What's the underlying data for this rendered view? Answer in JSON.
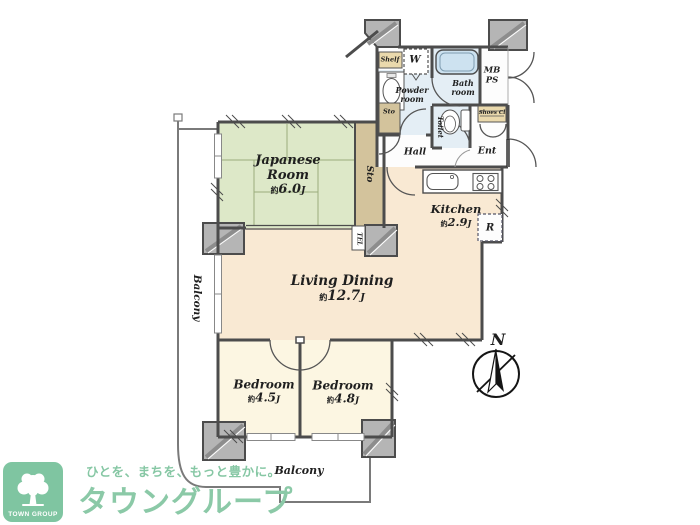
{
  "plan": {
    "rooms": [
      {
        "name": "Japanese Room",
        "area_prefix": "約",
        "area_value": "6.0",
        "area_unit": "J"
      },
      {
        "name": "Living Dining",
        "area_prefix": "約",
        "area_value": "12.7",
        "area_unit": "J"
      },
      {
        "name": "Kitchen",
        "area_prefix": "約",
        "area_value": "2.9",
        "area_unit": "J"
      },
      {
        "name": "Bedroom",
        "area_prefix": "約",
        "area_value": "4.5",
        "area_unit": "J"
      },
      {
        "name": "Bedroom",
        "area_prefix": "約",
        "area_value": "4.8",
        "area_unit": "J"
      }
    ],
    "labels": {
      "shelf": "Shelf",
      "washer": "W",
      "bath_1": "Bath",
      "bath_2": "room",
      "mb": "MB",
      "ps": "PS",
      "powder_1": "Powder",
      "powder_2": "room",
      "sto_small": "Sto",
      "sto_closet": "Sto",
      "toilet": "Toilet",
      "shoes_cl": "Shoes Cl",
      "hall": "Hall",
      "ent": "Ent",
      "tel": "TEL",
      "fridge": "R",
      "balcony_left": "Balcony",
      "balcony_bottom": "Balcony",
      "north": "N"
    }
  },
  "branding": {
    "logo_text": "TOWN GROUP",
    "tagline": "ひとを、まちを、もっと豊かに。",
    "brand_name": "タウングループ"
  },
  "colors": {
    "tatami_green": "#dde8c8",
    "closet_tan": "#d3c39c",
    "shelf_tan": "#ead9ac",
    "living_cream": "#f9e9d3",
    "bedroom_cream": "#fcf6e2",
    "wet_blue": "#e4eef5",
    "tub_blue": "#cde2f0",
    "wall_gray": "#4c4c4c",
    "pillar_gray": "#b5b5b5",
    "brand_green": "#8bc9a7",
    "logo_green": "#7fc5a1"
  }
}
